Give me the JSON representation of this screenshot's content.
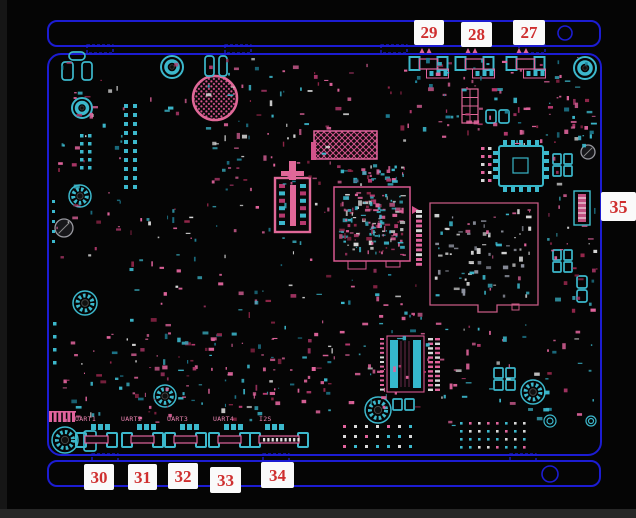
{
  "diagram": {
    "type": "pcb-component-layout",
    "callouts": {
      "top": [
        "29",
        "28",
        "27"
      ],
      "right": [
        "35"
      ],
      "bottom": [
        "30",
        "31",
        "32",
        "33",
        "34"
      ]
    },
    "silkscreen_labels": [
      "UART1",
      "UART2",
      "UART3",
      "UART4",
      "I2S"
    ],
    "colors": {
      "background": "#050505",
      "board_outline_blue": "#1c1cd2",
      "silkscreen_pink": "#e0649c",
      "pad_cyan": "#3cb8cc",
      "component_white": "#d8d8d8",
      "callout_text_red": "#cf2f2f",
      "callout_background": "#fafafa"
    }
  }
}
